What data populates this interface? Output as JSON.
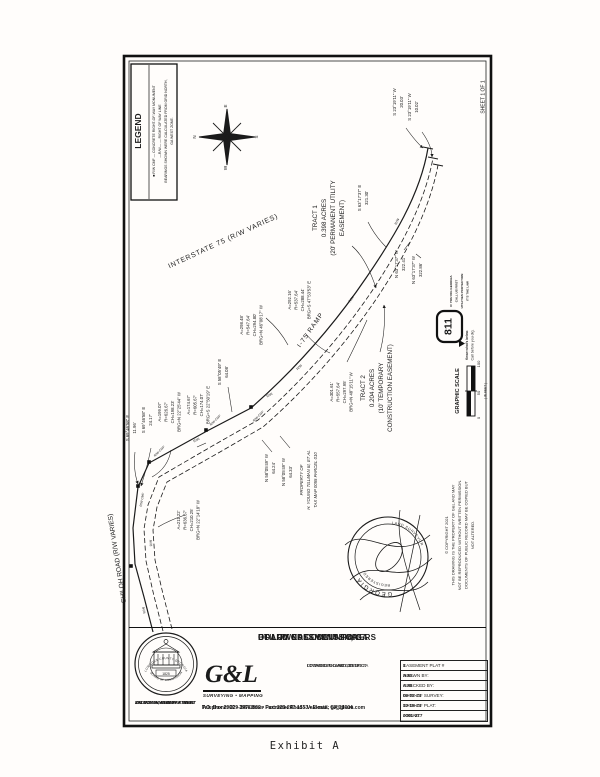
{
  "page": {
    "sheet_label": "SHEET 1  OF 1",
    "exhibit_label": "Exhibit A"
  },
  "legend": {
    "title": "LEGEND",
    "item1": "■ R/W CMF — CONCRETE RIGHT-OF-WAY MONUMENT",
    "item2": "—R/W—  —  RIGHT OF WAY LINE",
    "item3": "BEARINGS SHOWN WERE CALCULATED FROM GRID NORTH,",
    "item4": "GA WEST ZONE."
  },
  "compass": {
    "n": "N",
    "e": "E",
    "s": "S",
    "w": "W"
  },
  "roads": {
    "interstate": "INTERSTATE 75 (R/W VARIES)",
    "ramp": "I-75 RAMP",
    "shiloh": "SHILOH ROAD (R/W VARIES)",
    "rw": "R/W",
    "rw_cmf": "R/W CMF"
  },
  "tract1": {
    "l1": "TRACT 1",
    "l2": "0.398 ACRES",
    "l3": "(20' PERMANENT UTILITY",
    "l4": "EASEMENT)"
  },
  "tract2": {
    "l1": "TRACT 2",
    "l2": "0.204 ACRES",
    "l3": "(10' TEMPORARY",
    "l4": "CONSTRUCTION EASEMENT)"
  },
  "property": {
    "l1": "PROPERTY OF",
    "l2": "H. YOUNG TILLMAN III, ET AL",
    "l3": "TAX MAP 0055 PARCEL 010"
  },
  "bearings": {
    "b1a": "S 69°46'58\" E",
    "b1b": "11.96'",
    "b2a": "S 69°46'58\" E",
    "b2b": "24.17'",
    "b3a": "S 58°05'49\" E",
    "b3b": "64.08'",
    "b4a": "N 58°05'49\" W",
    "b4b": "64.24'",
    "b5a": "N 58°05'49\" W",
    "b5b": "64.33'",
    "b6a": "S 63°17'37\" E",
    "b6b": "321.30'",
    "b7a": "N 63°17'37\" W",
    "b7b": "322.41'",
    "b8a": "N 63°17'37\" W",
    "b8b": "322.86'",
    "b9a": "S 23°19'11\" W",
    "b9b": "20.03'",
    "b10a": "S 23°19'11\" W",
    "b10b": "10.02'"
  },
  "curves": {
    "c1": [
      "A=199.07'",
      "R=626.67'",
      "CH=198.23'",
      "BRG=N 22°25'44\" W"
    ],
    "c2": [
      "A=174.67'",
      "R=605.67'",
      "CH=174.07'",
      "BRG=S 22°50'19\" E"
    ],
    "c3": [
      "A=211.22'",
      "R=636.67'",
      "CH=210.25'",
      "BRG=N 22°14'18\" W"
    ],
    "c4": [
      "A=298.48'",
      "R=547.64'",
      "CH=294.80'",
      "BRG=N 46°08'17\" W"
    ],
    "c5": [
      "A=301.61'",
      "R=557.64'",
      "CH=297.95'",
      "BRG=N 48°15'11\" W"
    ],
    "c6": [
      "A=292.16'",
      "R=537.64'",
      "CH=288.44'",
      "BRG=S 47°53'53\" E"
    ]
  },
  "scale": {
    "title": "GRAPHIC SCALE",
    "t0": "0",
    "t50": "50",
    "t100": "100",
    "unit": "( IN FEET )"
  },
  "call811": {
    "logo": "811",
    "l1": "IF YOU DIG GEORGIA",
    "l2": "CALL US FIRST",
    "l3": "UTILITIES PROTECTION",
    "l4": "IT'S THE LAW",
    "k1": "Know what's below.",
    "k2": "Call before you dig."
  },
  "seal": {
    "arc1": "GEORGIA",
    "arc2": "REGISTERED",
    "arc3": "LAND SURVEYOR"
  },
  "copyright": {
    "l1": "© COPYRIGHT 2021",
    "l2": "THIS DRAWING IS THE PROPERTY OF G&L AND MAY",
    "l3": "NOT BE REPRODUCED WITHOUT WRITTEN PERMISSION.",
    "l4": "DOCUMENTS OF PUBLIC RECORD MAY BE COPIED BUT",
    "l5": "NOT ALTERED."
  },
  "titleblock": {
    "title1": "UTILITY EASEMENT FOR:",
    "title2": "BOARD OF COMMISSIONERS",
    "title3": "OF LOWNDES COUNTY, GA",
    "located1": "LOCATED IN LAND LOT 57",
    "located2": "OF THE 12TH LAND DISTRICT",
    "located3": "LOWNDES COUNTY,  GEORGIA",
    "gl_logo": "G&L",
    "gl_sub": "SURVEYING • MAPPING",
    "addr1": "P.O. Box 2960  •  3998 Inner Perimeter Road  •  Valdosta, GA 31604",
    "addr2": "Telephone: 229-247-1552 • Fax: 229-247-1553 • E-mail: gl@gl-sm.com",
    "dept1": "ENGINEERING DEPARTMENT",
    "dept2": "327 NORTH ASHLEY STREET",
    "dept3": "VALDOSTA, GEORGIA 31601",
    "seal_top": "LOWNDES COUNTY GEORGIA",
    "seal_bottom": "BOARD OF COMMISSIONERS",
    "seal_year": "1825"
  },
  "table": {
    "rows": [
      {
        "label": "EASEMENT PLAT #",
        "value": "1"
      },
      {
        "label": "DRAWN BY:",
        "value": "AJG"
      },
      {
        "label": "CHECKED BY:",
        "value": "AJG"
      },
      {
        "label": "DATE OF SURVEY:",
        "value": "06-02-21"
      },
      {
        "label": "DATE OF PLAT:",
        "value": "10-19-21"
      },
      {
        "label": "JOB No.",
        "value": "0001-277"
      }
    ]
  }
}
